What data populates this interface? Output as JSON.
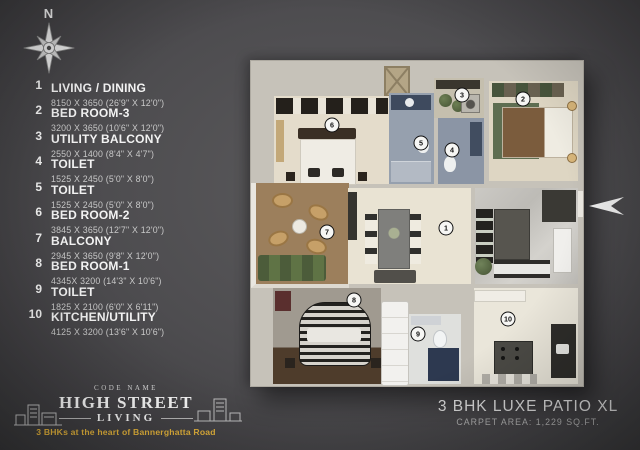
{
  "compass": {
    "label": "N"
  },
  "legend": {
    "items": [
      {
        "num": "1",
        "name": "LIVING / DINING",
        "dims": "8150 X 3650  (26'9\" X 12'0\")"
      },
      {
        "num": "2",
        "name": "BED ROOM-3",
        "dims": "3200 X 3650  (10'6\" X 12'0\")"
      },
      {
        "num": "3",
        "name": "UTILITY BALCONY",
        "dims": "2550 X 1400  (8'4\" X 4'7\")"
      },
      {
        "num": "4",
        "name": "TOILET",
        "dims": "1525 X 2450  (5'0\" X 8'0\")"
      },
      {
        "num": "5",
        "name": "TOILET",
        "dims": "1525 X 2450  (5'0\" X 8'0\")"
      },
      {
        "num": "6",
        "name": "BED ROOM-2",
        "dims": "3845 X 3650  (12'7\" X 12'0\")"
      },
      {
        "num": "7",
        "name": "BALCONY",
        "dims": "2945 X 3650  (9'8\" X 12'0\")"
      },
      {
        "num": "8",
        "name": "BED ROOM-1",
        "dims": "4345X 3200  (14'3\" X 10'6\")"
      },
      {
        "num": "9",
        "name": "TOILET",
        "dims": "1825 X 2100  (6'0\" X 6'11\")"
      },
      {
        "num": "10",
        "name": "KITCHEN/UTILITY",
        "dims": "4125 X 3200  (13'6\" X 10'6\")"
      }
    ]
  },
  "branding": {
    "code_label": "CODE NAME",
    "name_line1": "HIGH STREET",
    "name_line2": "LIVING",
    "tagline": "3 BHKs at the heart of Bannerghatta Road",
    "accent_color": "#E8B63C"
  },
  "plan_info": {
    "title": "3 BHK LUXE PATIO XL",
    "carpet_area": "CARPET AREA: 1,229 SQ.FT."
  },
  "floorplan": {
    "badges": [
      "1",
      "2",
      "3",
      "4",
      "5",
      "6",
      "7",
      "8",
      "9",
      "10"
    ]
  }
}
